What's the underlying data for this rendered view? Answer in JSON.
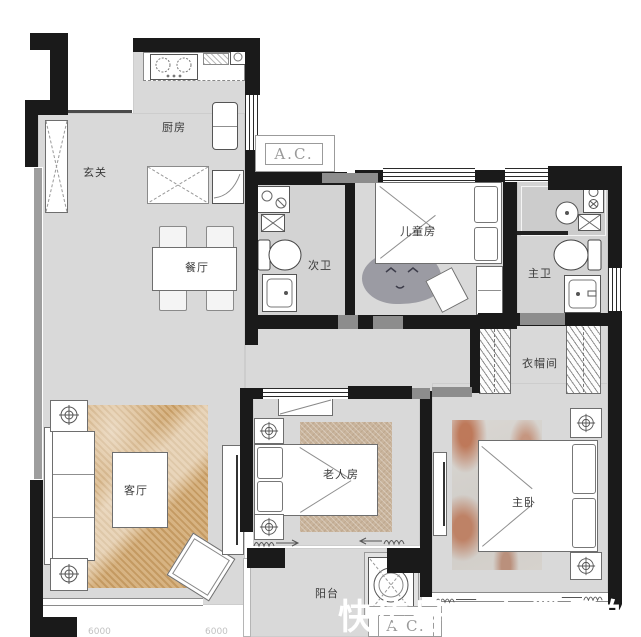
{
  "canvas": {
    "width": 641,
    "height": 637
  },
  "rooms": {
    "kitchen": "厨房",
    "entry": "玄关",
    "dining": "餐厅",
    "bath2": "次卫",
    "kids": "儿童房",
    "bath1": "主卫",
    "closet": "衣帽间",
    "living": "客厅",
    "elder": "老人房",
    "master": "主卧",
    "balcony": "阳台"
  },
  "ac": {
    "top": "A.C.",
    "bottom": "A.C."
  },
  "watermark": "快传号 / 左撇子的家居",
  "dimensions": {
    "left": "6000",
    "right": "6000"
  },
  "colors": {
    "wall": "#1a1a1a",
    "floor": "#d9d9d9",
    "living_rug": "#cfa873",
    "elder_rug": "#c9b49c",
    "master_rug_vein": "#b55a32",
    "kids_rug": "#9b9ba3",
    "watermark": "#ffffff",
    "ac_text": "#9a9a9a"
  }
}
